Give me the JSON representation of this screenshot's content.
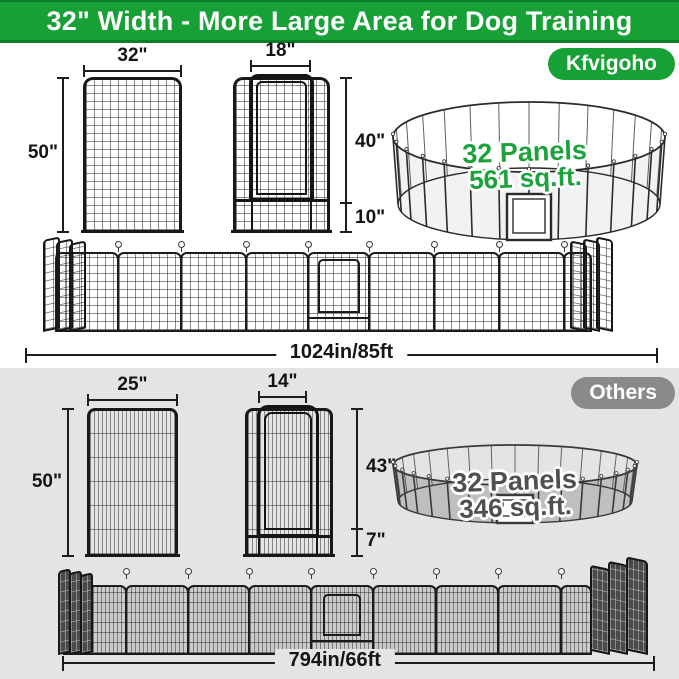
{
  "banner": {
    "title": "32\" Width - More Large Area for Dog Training"
  },
  "brand": {
    "badge": "Kfvigoho",
    "panel": {
      "width": "32\"",
      "height": "50\""
    },
    "door_panel": {
      "door_width": "18\"",
      "door_height": "40\"",
      "bottom_height": "10\""
    },
    "pen": {
      "line1": "32 Panels",
      "line2": "561 sq.ft."
    },
    "total_length": "1024in/85ft"
  },
  "others": {
    "badge": "Others",
    "panel": {
      "width": "25\"",
      "height": "50\""
    },
    "door_panel": {
      "door_width": "14\"",
      "door_height": "43\"",
      "bottom_height": "7\""
    },
    "pen": {
      "line1": "32 Panels",
      "line2": "346 sq.ft."
    },
    "total_length": "794in/66ft"
  },
  "colors": {
    "brand_green": "#17A035",
    "banner_edge_green": "#0E7D27",
    "others_gray": "#8A8A8A",
    "others_bg": "#E4E4E4",
    "pen_text_green": "#1CA23A",
    "pen_text_gray": "#4F4F4F"
  }
}
